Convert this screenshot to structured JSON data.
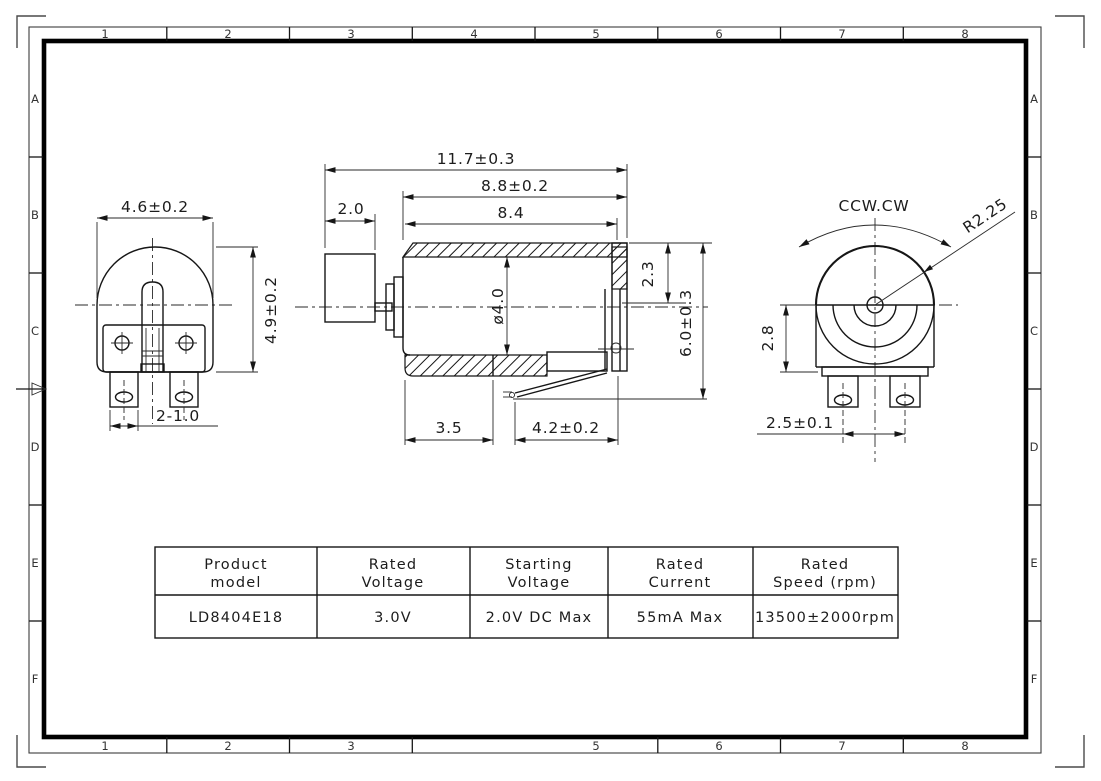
{
  "frame": {
    "top_labels": [
      "1",
      "2",
      "3",
      "4",
      "5",
      "6",
      "7",
      "8"
    ],
    "bottom_labels": [
      "1",
      "2",
      "3",
      "5",
      "6",
      "7",
      "8"
    ],
    "left_labels": [
      "A",
      "B",
      "C",
      "D",
      "E",
      "F"
    ],
    "right_labels": [
      "A",
      "B",
      "C",
      "D",
      "E",
      "F"
    ]
  },
  "views": {
    "front": {
      "dim_width": "4.6±0.2",
      "dim_height": "4.9±0.2",
      "dim_legs": "2-1.0"
    },
    "side": {
      "dim_total": "11.7±0.3",
      "dim_body_cap": "8.8±0.2",
      "dim_body": "8.4",
      "dim_weight": "2.0",
      "dim_diameter": "ø4.0",
      "dim_terminal": "2.3",
      "dim_height": "6.0±0.3",
      "dim_sleeve": "3.5",
      "dim_lead": "4.2±0.2"
    },
    "rear": {
      "rotation_label": "CCW.CW",
      "dim_radius": "R2.25",
      "dim_body_height": "2.8",
      "dim_leg_pitch": "2.5±0.1"
    }
  },
  "table": {
    "headers": [
      {
        "line1": "Product",
        "line2": "model"
      },
      {
        "line1": "Rated",
        "line2": "Voltage"
      },
      {
        "line1": "Starting",
        "line2": "Voltage"
      },
      {
        "line1": "Rated",
        "line2": "Current"
      },
      {
        "line1": "Rated",
        "line2": "Speed (rpm)"
      }
    ],
    "row": [
      "LD8404E18",
      "3.0V",
      "2.0V DC Max",
      "55mA Max",
      "13500±2000rpm"
    ]
  }
}
